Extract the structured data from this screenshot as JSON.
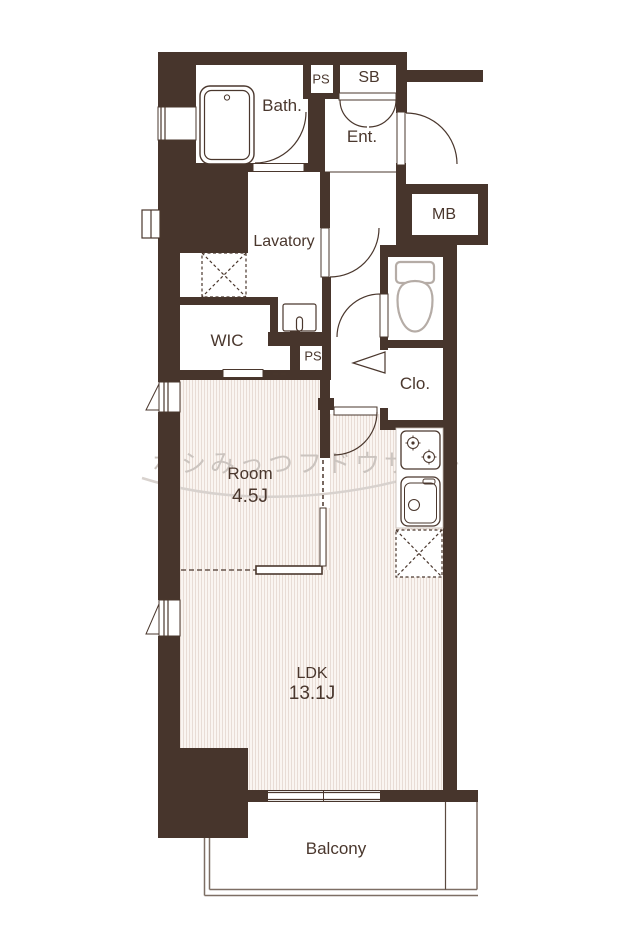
{
  "plan": {
    "type": "apartment-floorplan",
    "watermark": {
      "text": "ホシみっつフドウサン"
    },
    "labels": {
      "bath": "Bath.",
      "ps_top": "PS",
      "sb": "SB",
      "ent": "Ent.",
      "mb": "MB",
      "lavatory": "Lavatory",
      "wic": "WIC",
      "ps_bottom": "PS",
      "clo": "Clo.",
      "room": "Room",
      "room_size": "4.5J",
      "ldk": "LDK",
      "ldk_size": "13.1J",
      "balcony": "Balcony"
    },
    "colors": {
      "wall": "#47352c",
      "label_text": "#4a372d",
      "floor_stripe": "#e8dcd5",
      "floor_bg": "#faf5f1",
      "fixture_gray": "#b5aca6",
      "watermark_gray": "#cbc4bf",
      "balcony_line": "#7d6e64"
    }
  }
}
